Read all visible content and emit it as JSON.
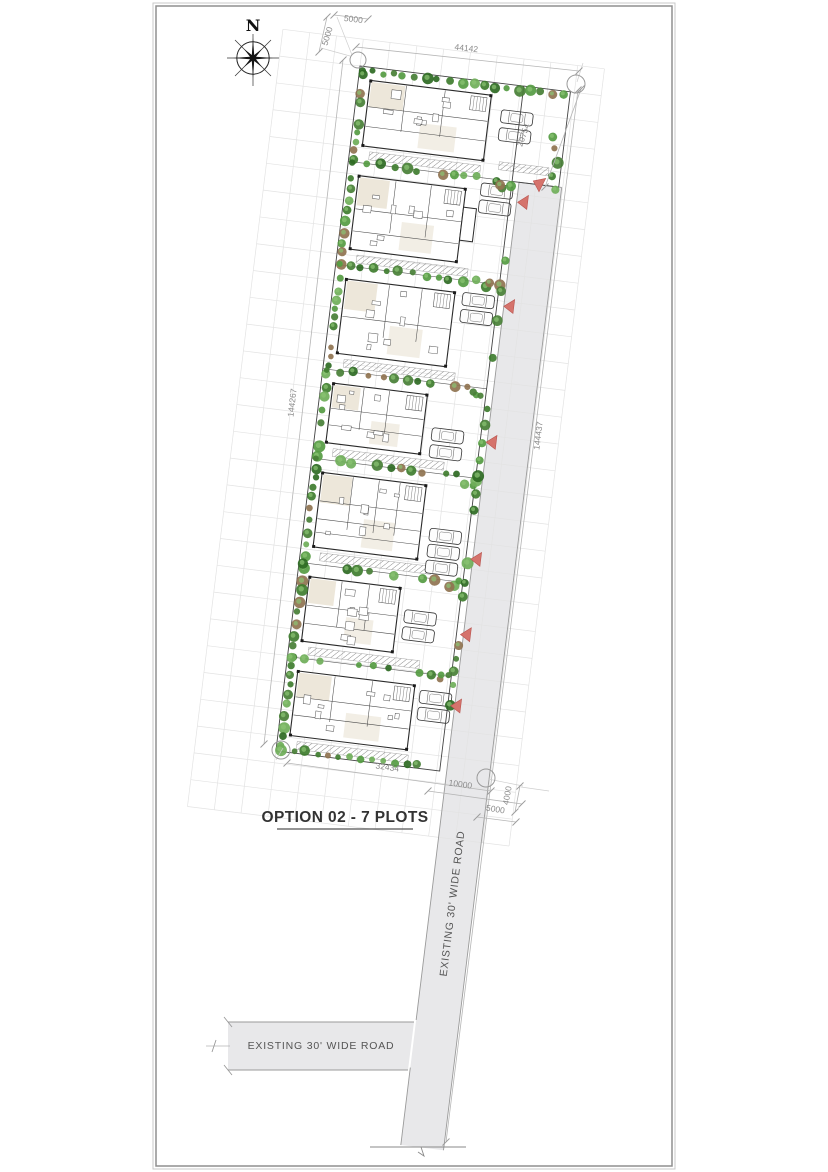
{
  "title": {
    "text": "OPTION 02 - 7 PLOTS"
  },
  "compass": {
    "label": "N"
  },
  "roads": {
    "vertical_label": "EXISTING 30' WIDE ROAD",
    "horizontal_label": "EXISTING 30' WIDE ROAD"
  },
  "site": {
    "plot_count": 7,
    "option_number": "02"
  },
  "dimensions": [
    {
      "id": "top-left-offset-h",
      "value": "5000"
    },
    {
      "id": "top-left-offset-v",
      "value": "5000"
    },
    {
      "id": "top-width",
      "value": "44142"
    },
    {
      "id": "plot1-right-depth",
      "value": "20754"
    },
    {
      "id": "west-boundary-length",
      "value": "144267"
    },
    {
      "id": "east-road-length",
      "value": "144437"
    },
    {
      "id": "south-width",
      "value": "32434"
    },
    {
      "id": "south-road-width",
      "value": "10000"
    },
    {
      "id": "southeast-offset-v",
      "value": "4000"
    },
    {
      "id": "southeast-offset-h",
      "value": "5000"
    }
  ],
  "colors": {
    "paper": "#ffffff",
    "road_fill": "#e8e8ea",
    "dim_line": "#b5b5b5",
    "dim_text": "#8b8b8b",
    "plan_line_dark": "#2a2a2a",
    "room_beige": "#eae3d3",
    "tree_greens": [
      "#3f7d2f",
      "#559b42",
      "#2e6a23",
      "#6fae59",
      "#487f36"
    ],
    "tree_highlight": "#8cc474",
    "tree_brown": "#8f7350",
    "entrance_arrow_fill": "#d5736c",
    "entrance_arrow_stroke": "#b9534e"
  }
}
